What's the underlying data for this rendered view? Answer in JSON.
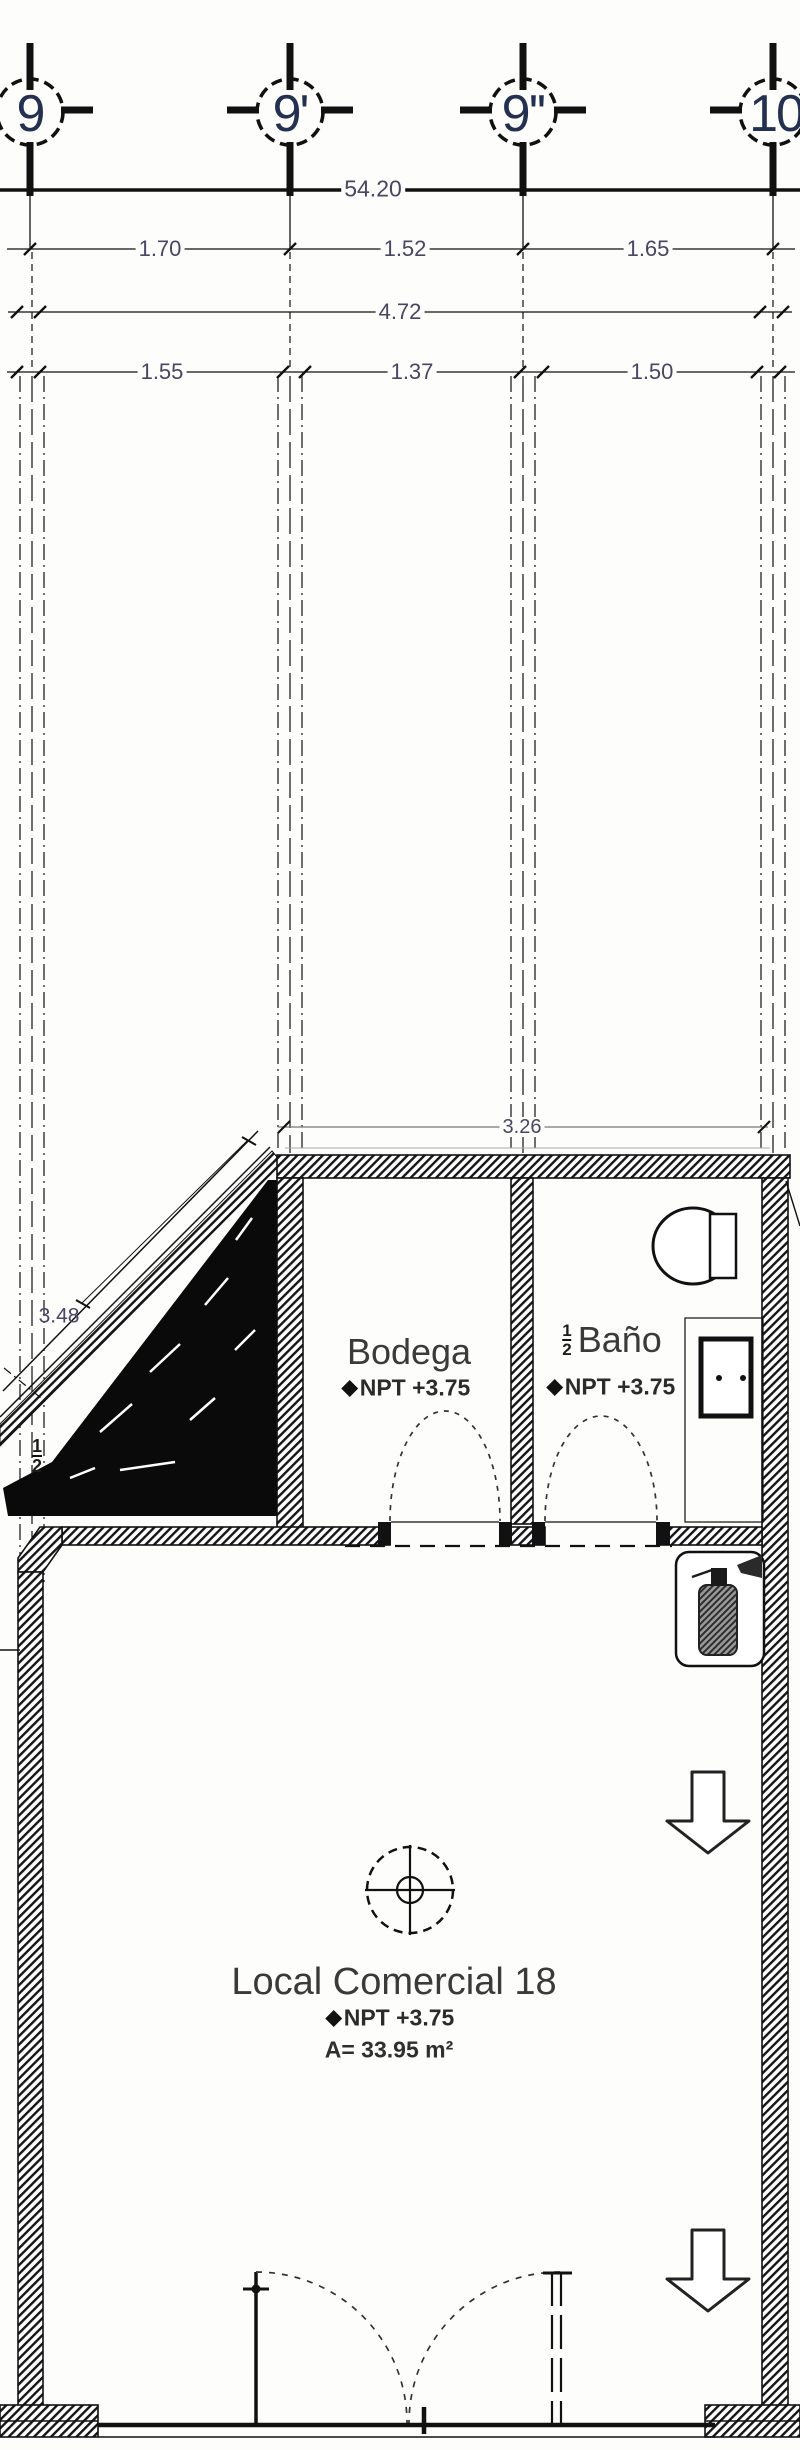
{
  "document": {
    "type": "architectural floor plan",
    "sheet_unit": "Local Comercial 18"
  },
  "grid_bubbles": [
    {
      "label": "9"
    },
    {
      "label": "9'"
    },
    {
      "label": "9''"
    },
    {
      "label": "10"
    }
  ],
  "dimensions": {
    "overall_top": "54.20",
    "axis_row": [
      "1.70",
      "1.52",
      "1.65"
    ],
    "overall_inner": "4.72",
    "clear_row": [
      "1.55",
      "1.37",
      "1.50"
    ],
    "bodega_width": "3.26",
    "ramp_length": "3.48",
    "ramp_slope": {
      "numerator": "1",
      "denominator": "2"
    }
  },
  "rooms": {
    "bodega": {
      "name": "Bodega",
      "level": "NPT +3.75"
    },
    "banio": {
      "fraction": {
        "numerator": "1",
        "denominator": "2"
      },
      "name": "Baño",
      "level": "NPT +3.75"
    },
    "local": {
      "name": "Local Comercial 18",
      "level": "NPT +3.75",
      "area": "A= 33.95 m²"
    }
  },
  "colors": {
    "line": "#111111",
    "dimension_text": "#4a4563",
    "bubble_text": "#233050",
    "label_text": "#3a3a3a",
    "background": "#fdfdfb"
  }
}
